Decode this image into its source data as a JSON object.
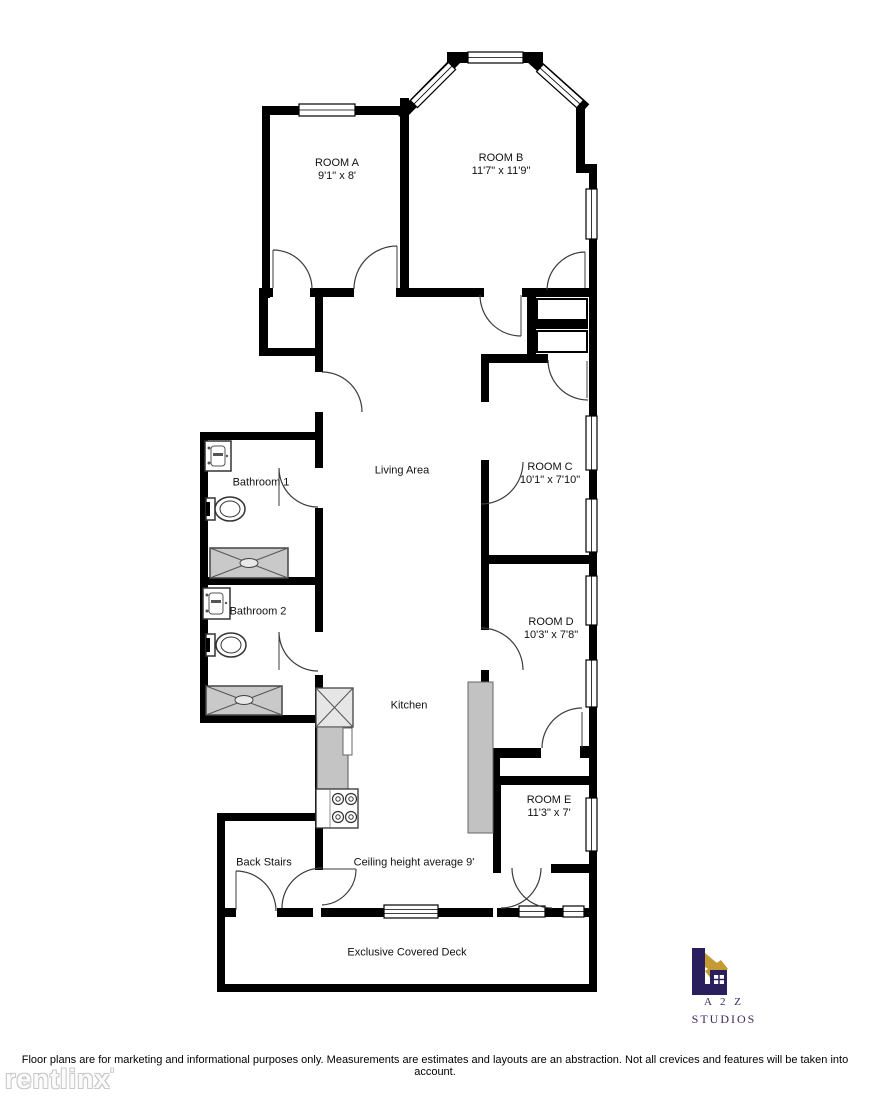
{
  "floor_plan": {
    "rooms": {
      "room_a": {
        "name": "ROOM A",
        "dims": "9'1\" x 8'"
      },
      "room_b": {
        "name": "ROOM B",
        "dims": "11'7\" x 11'9\""
      },
      "room_c": {
        "name": "ROOM C",
        "dims": "10'1\" x 7'10\""
      },
      "room_d": {
        "name": "ROOM D",
        "dims": "10'3\" x 7'8\""
      },
      "room_e": {
        "name": "ROOM E",
        "dims": "11'3\" x 7'"
      },
      "living_area": {
        "name": "Living Area"
      },
      "kitchen": {
        "name": "Kitchen"
      },
      "bathroom_1": {
        "name": "Bathroom 1"
      },
      "bathroom_2": {
        "name": "Bathroom 2"
      },
      "back_stairs": {
        "name": "Back Stairs"
      },
      "deck": {
        "name": "Exclusive Covered Deck"
      }
    },
    "notes": {
      "ceiling": "Ceiling height average 9'"
    }
  },
  "branding": {
    "logo_line1": "A 2 Z",
    "logo_line2": "STUDIOS",
    "colors": {
      "navy": "#2b1e5c",
      "gold": "#c49b32"
    }
  },
  "watermark": {
    "text": "rentlinx",
    "mark": "'"
  },
  "footer": {
    "disclaimer": "Floor plans are for marketing and informational purposes only. Measurements are estimates and layouts are an abstraction. Not all crevices and features will be taken into account."
  }
}
